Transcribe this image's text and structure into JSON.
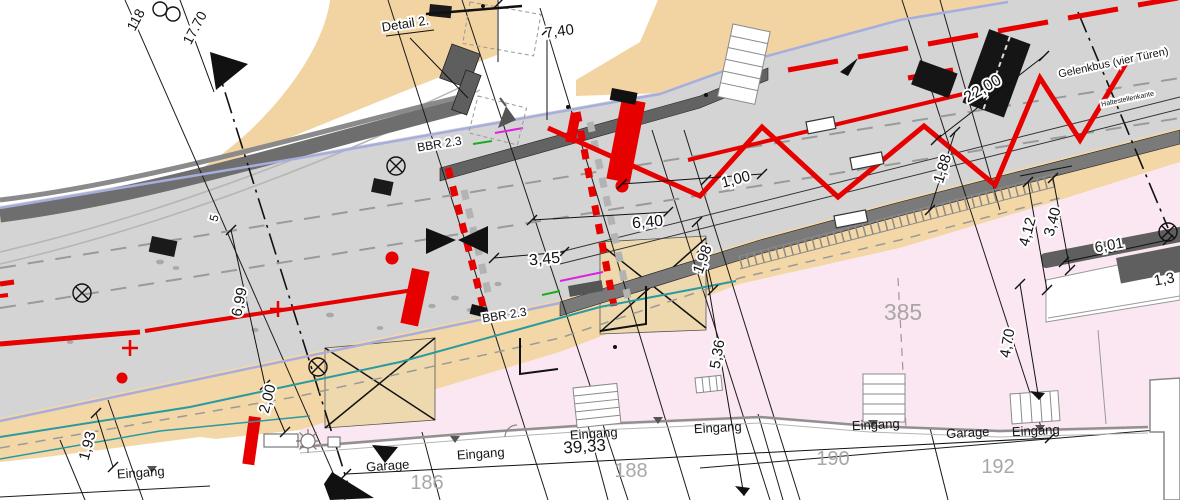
{
  "drawing_type": "site-plan (German street / bus-stop construction plan)",
  "palette": {
    "road_gray": "#d4d4d4",
    "sidewalk_tan": "#f3d7a7",
    "plot_pink": "#fbe7f2",
    "marking_red": "#e60000",
    "edge_teal": "#2b9aa0",
    "wall_dark": "#5f5f5f",
    "edge_lavender": "#a6aede",
    "detail_magenta": "#e020e0",
    "detail_green": "#1faa1f"
  },
  "labels": {
    "dimensions": [
      {
        "text": "7,40",
        "x": 560,
        "y": 36,
        "r": -8,
        "size": 15
      },
      {
        "text": "22,00",
        "x": 985,
        "y": 93,
        "r": -30,
        "size": 16
      },
      {
        "text": "1,88",
        "x": 947,
        "y": 170,
        "r": -73,
        "size": 15
      },
      {
        "text": "1,00",
        "x": 737,
        "y": 184,
        "r": -15,
        "size": 15
      },
      {
        "text": "6,40",
        "x": 648,
        "y": 227,
        "r": -5,
        "size": 16
      },
      {
        "text": "3,45",
        "x": 545,
        "y": 264,
        "r": -5,
        "size": 16
      },
      {
        "text": "6,99",
        "x": 244,
        "y": 303,
        "r": -78,
        "size": 15
      },
      {
        "text": "2,00",
        "x": 272,
        "y": 400,
        "r": -75,
        "size": 15
      },
      {
        "text": "1,93",
        "x": 92,
        "y": 447,
        "r": -75,
        "size": 15
      },
      {
        "text": "5,36",
        "x": 722,
        "y": 355,
        "r": -80,
        "size": 15
      },
      {
        "text": "1,98",
        "x": 707,
        "y": 261,
        "r": -70,
        "size": 15
      },
      {
        "text": "4,12",
        "x": 1032,
        "y": 233,
        "r": -75,
        "size": 15
      },
      {
        "text": "3,40",
        "x": 1057,
        "y": 223,
        "r": -75,
        "size": 15
      },
      {
        "text": "6,01",
        "x": 1110,
        "y": 250,
        "r": -10,
        "size": 15
      },
      {
        "text": "4,70",
        "x": 1012,
        "y": 344,
        "r": -80,
        "size": 15
      },
      {
        "text": "1,3",
        "x": 1165,
        "y": 284,
        "r": -10,
        "size": 15
      },
      {
        "text": "39,33",
        "x": 585,
        "y": 452,
        "r": -4,
        "size": 17
      },
      {
        "text": "17.70",
        "x": 199,
        "y": 30,
        "r": -62,
        "size": 14
      },
      {
        "text": "118",
        "x": 140,
        "y": 22,
        "r": -62,
        "size": 14
      },
      {
        "text": "5",
        "x": 218,
        "y": 219,
        "r": -75,
        "size": 12
      }
    ],
    "annotations": [
      {
        "text": "Detail 2.",
        "x": 406,
        "y": 28,
        "r": -9,
        "size": 13
      },
      {
        "text": "BBR 2.3",
        "x": 440,
        "y": 148,
        "r": -9,
        "size": 12
      },
      {
        "text": "BBR 2.3",
        "x": 505,
        "y": 319,
        "r": -9,
        "size": 12
      },
      {
        "text": "Gelenkbus (vier Türen)",
        "x": 1114,
        "y": 66,
        "r": -12,
        "size": 11
      },
      {
        "text": "Haltestellenkante",
        "x": 1128,
        "y": 101,
        "r": -12,
        "size": 7
      }
    ],
    "entrances": [
      {
        "text": "Eingang",
        "x": 141,
        "y": 477,
        "r": -4
      },
      {
        "text": "Eingang",
        "x": 481,
        "y": 458,
        "r": -4
      },
      {
        "text": "Eingang",
        "x": 594,
        "y": 438,
        "r": -4
      },
      {
        "text": "Eingang",
        "x": 718,
        "y": 432,
        "r": -3
      },
      {
        "text": "Eingang",
        "x": 876,
        "y": 429,
        "r": -3
      },
      {
        "text": "Eingang",
        "x": 1036,
        "y": 435,
        "r": -3
      },
      {
        "text": "Garage",
        "x": 388,
        "y": 470,
        "r": -4
      },
      {
        "text": "Garage",
        "x": 968,
        "y": 437,
        "r": -3
      }
    ],
    "plot_numbers": [
      {
        "text": "186",
        "x": 427,
        "y": 489,
        "size": 20
      },
      {
        "text": "188",
        "x": 631,
        "y": 477,
        "size": 20
      },
      {
        "text": "190",
        "x": 833,
        "y": 465,
        "size": 20
      },
      {
        "text": "192",
        "x": 998,
        "y": 473,
        "size": 20
      },
      {
        "text": "385",
        "x": 903,
        "y": 320,
        "size": 23
      }
    ]
  }
}
